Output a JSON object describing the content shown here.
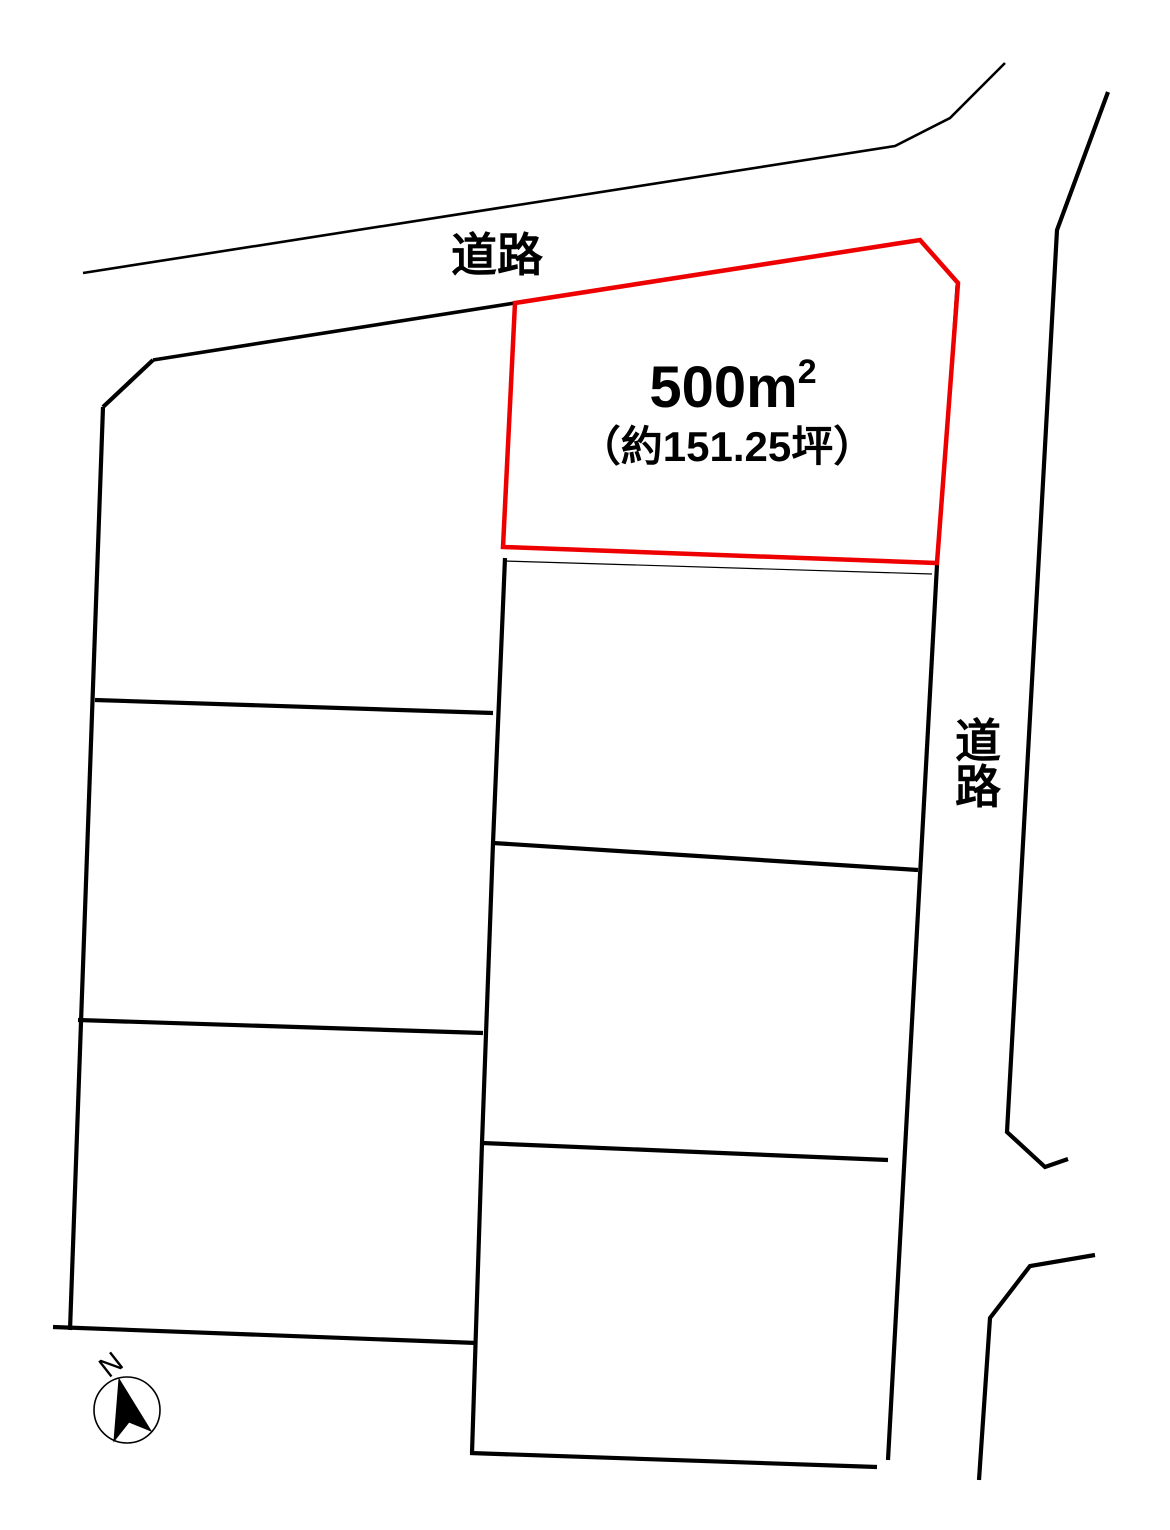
{
  "colors": {
    "line": "#000000",
    "highlight": "#ee0000",
    "background": "#ffffff"
  },
  "labels": {
    "road_top": "道路",
    "road_right_chars": [
      "道",
      "路"
    ],
    "compass_north": "N"
  },
  "highlight_plot": {
    "area_value": "500",
    "area_unit": "m",
    "area_exponent": "2",
    "area_tsubo": "（約151.25坪）",
    "outline_points": "515,303 920,240 958,283 937,563 503,547",
    "stroke_width": 4.5
  },
  "geometry": {
    "black_lines": [
      {
        "name": "top-road-upper-edge",
        "points": "83,273 895,146 950,118 1005,63",
        "width": 2.6
      },
      {
        "name": "top-road-lower-edge",
        "points": "153,360 515,303",
        "width": 3.6
      },
      {
        "name": "left-corner-chamfer",
        "points": "103,407 153,360",
        "width": 4.2
      },
      {
        "name": "left-outer-boundary",
        "points": "103,407 70,1330",
        "width": 4.2
      },
      {
        "name": "central-boundary",
        "points": "505,558 493,843 482,1143 472,1453",
        "width": 4.2
      },
      {
        "name": "left-divider-1",
        "points": "95,700 493,713",
        "width": 4.2
      },
      {
        "name": "left-divider-2",
        "points": "78,1020 483,1033",
        "width": 4.2
      },
      {
        "name": "left-divider-3",
        "points": "53,1327 477,1343",
        "width": 4.2
      },
      {
        "name": "right-outer-boundary",
        "points": "937,565 888,1460",
        "width": 4.2
      },
      {
        "name": "right-divider-2",
        "points": "493,843 918,870",
        "width": 4.2
      },
      {
        "name": "right-divider-3",
        "points": "482,1143 888,1160",
        "width": 4.2
      },
      {
        "name": "right-column-bottom",
        "points": "470,1453 877,1467",
        "width": 4.2
      },
      {
        "name": "right-road-east-edge",
        "points": "1108,92 1057,230 1007,1132 1045,1167 1068,1159",
        "width": 4.2
      },
      {
        "name": "right-road-south-edge",
        "points": "1095,1255 1030,1266 990,1318 979,1480",
        "width": 4.2
      }
    ],
    "thin_lines": [
      {
        "name": "plot-right-survey-line",
        "points": "956,285 938,560",
        "width": 1.2
      },
      {
        "name": "plot-bottom-survey-line",
        "points": "505,561 932,574",
        "width": 1.2
      }
    ],
    "compass": {
      "cx": 127,
      "cy": 1410,
      "r": 33,
      "circle_stroke": 1.6,
      "arrow_points": "119,1379 151,1431 129,1422 114,1441"
    }
  }
}
